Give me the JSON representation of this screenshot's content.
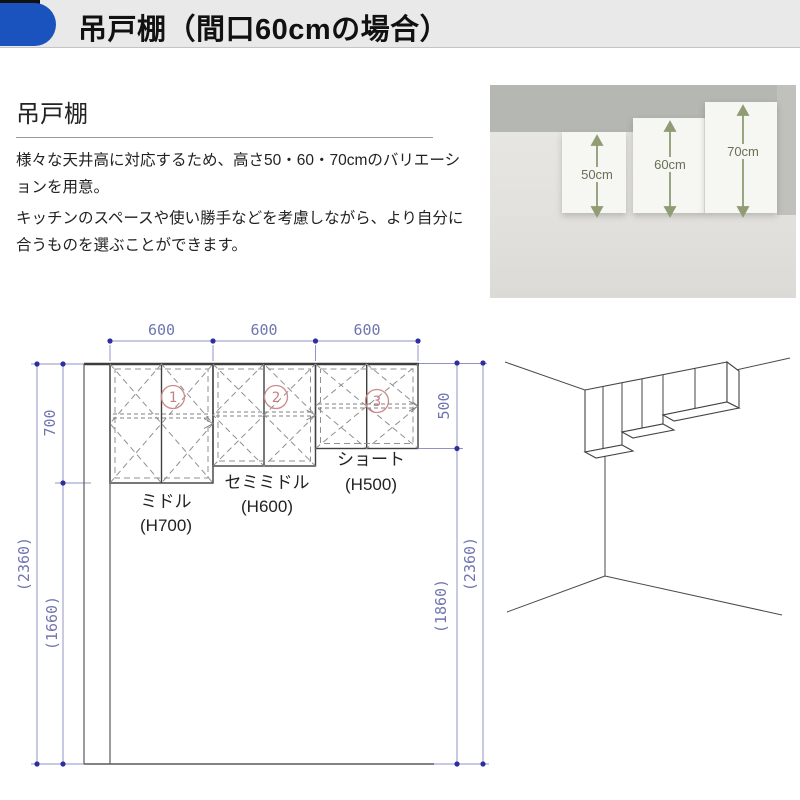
{
  "header": {
    "title": "吊戸棚（間口60cmの場合）"
  },
  "intro": {
    "subtitle": "吊戸棚",
    "paragraph1": "様々な天井高に対応するため、高さ50・60・70cmのバリエーションを用意。",
    "paragraph2": "キッチンのスペースや使い勝手などを考慮しながら、より自分に合うものを選ぶことができます。"
  },
  "photo": {
    "height_labels": [
      "50cm",
      "60cm",
      "70cm"
    ],
    "arrow_color": "#8f9c74"
  },
  "plan": {
    "top_widths": [
      "600",
      "600",
      "600"
    ],
    "left_height": "700",
    "left_total": "(2360)",
    "left_below": "(1660)",
    "right_height": "500",
    "right_total": "(2360)",
    "right_below": "(1860)",
    "cabinets": [
      {
        "num": "1",
        "name": "ミドル",
        "size": "(H700)"
      },
      {
        "num": "2",
        "name": "セミミドル",
        "size": "(H600)"
      },
      {
        "num": "3",
        "name": "ショート",
        "size": "(H500)"
      }
    ],
    "colors": {
      "dimension": "#7076b0",
      "callout": "#c87f7f",
      "accent": "#1a53bd"
    }
  }
}
